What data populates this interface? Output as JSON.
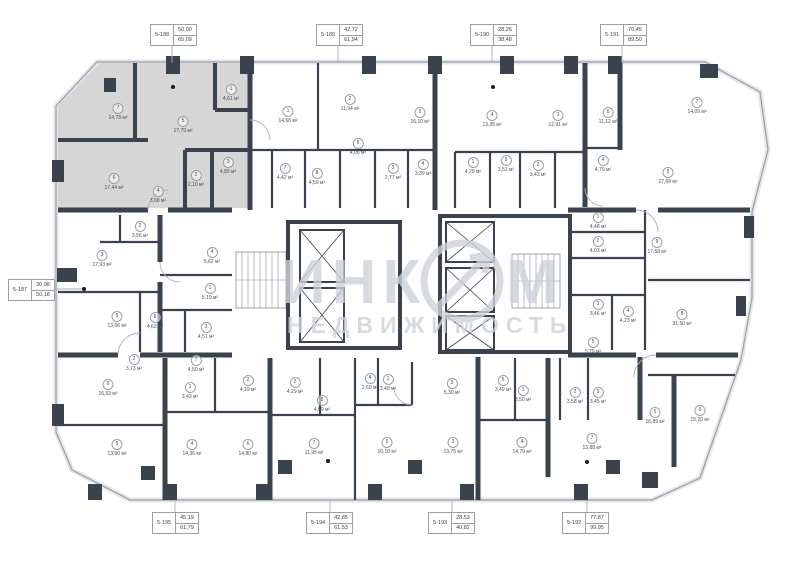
{
  "watermark": {
    "brand": "ИНКОМ",
    "brand_left": "ИНК",
    "brand_right": "М",
    "subtitle": "НЕДВИЖИМОСТЬ"
  },
  "units": [
    {
      "id": "5-188",
      "area1": "50,00",
      "area2": "65,09",
      "x": 150,
      "y": 24,
      "leader": [
        172,
        44,
        172,
        63
      ]
    },
    {
      "id": "5-189",
      "area1": "42,72",
      "area2": "61,94",
      "x": 316,
      "y": 24,
      "leader": [
        338,
        44,
        338,
        63
      ]
    },
    {
      "id": "5-190",
      "area1": "28,26",
      "area2": "38,48",
      "x": 470,
      "y": 24,
      "leader": [
        492,
        44,
        492,
        63
      ]
    },
    {
      "id": "5-191",
      "area1": "70,45",
      "area2": "89,50",
      "x": 600,
      "y": 24,
      "leader": [
        622,
        44,
        622,
        63
      ]
    },
    {
      "id": "5-187",
      "area1": "30,98",
      "area2": "50,18",
      "x": 8,
      "y": 279,
      "leader": [
        54,
        289,
        84,
        289
      ],
      "dot": [
        84,
        289
      ]
    },
    {
      "id": "5-195",
      "area1": "45,19",
      "area2": "61,79",
      "x": 152,
      "y": 512,
      "leader": [
        175,
        500,
        175,
        512
      ]
    },
    {
      "id": "5-194",
      "area1": "42,85",
      "area2": "61,53",
      "x": 306,
      "y": 512,
      "leader": [
        330,
        500,
        330,
        512
      ]
    },
    {
      "id": "5-193",
      "area1": "28,53",
      "area2": "40,82",
      "x": 428,
      "y": 512,
      "leader": [
        452,
        500,
        452,
        512
      ]
    },
    {
      "id": "5-192",
      "area1": "77,87",
      "area2": "99,95",
      "x": 562,
      "y": 512,
      "leader": [
        587,
        500,
        587,
        512
      ]
    }
  ],
  "rooms": [
    {
      "n": "7",
      "a": "14,78 м²",
      "x": 118,
      "y": 112
    },
    {
      "n": "5",
      "a": "17,79 м²",
      "x": 183,
      "y": 125
    },
    {
      "n": "1",
      "a": "4,61 м²",
      "x": 231,
      "y": 93
    },
    {
      "n": "3",
      "a": "4,89 м²",
      "x": 228,
      "y": 166
    },
    {
      "n": "2",
      "a": "2,10 м²",
      "x": 196,
      "y": 179
    },
    {
      "n": "6",
      "a": "17,44 м²",
      "x": 114,
      "y": 182
    },
    {
      "n": "4",
      "a": "3,68 м²",
      "x": 158,
      "y": 195
    },
    {
      "n": "1",
      "a": "14,68 м²",
      "x": 288,
      "y": 115
    },
    {
      "n": "2",
      "a": "11,94 м²",
      "x": 350,
      "y": 103
    },
    {
      "n": "6",
      "a": "4,06 м²",
      "x": 358,
      "y": 147
    },
    {
      "n": "7",
      "a": "4,42 м²",
      "x": 285,
      "y": 172
    },
    {
      "n": "8",
      "a": "4,59 м²",
      "x": 317,
      "y": 177
    },
    {
      "n": "3",
      "a": "2,77 м²",
      "x": 393,
      "y": 172
    },
    {
      "n": "5",
      "a": "16,10 м²",
      "x": 420,
      "y": 116
    },
    {
      "n": "4",
      "a": "3,39 м²",
      "x": 423,
      "y": 168
    },
    {
      "n": "4",
      "a": "13,35 м²",
      "x": 492,
      "y": 119
    },
    {
      "n": "3",
      "a": "12,91 м²",
      "x": 558,
      "y": 119
    },
    {
      "n": "6",
      "a": "11,12 м²",
      "x": 608,
      "y": 116
    },
    {
      "n": "1",
      "a": "4,29 м²",
      "x": 473,
      "y": 166
    },
    {
      "n": "5",
      "a": "3,51 м²",
      "x": 506,
      "y": 164
    },
    {
      "n": "2",
      "a": "3,43 м²",
      "x": 538,
      "y": 169
    },
    {
      "n": "4",
      "a": "4,79 м²",
      "x": 603,
      "y": 164
    },
    {
      "n": "7",
      "a": "14,09 м²",
      "x": 697,
      "y": 106
    },
    {
      "n": "5",
      "a": "27,68 м²",
      "x": 668,
      "y": 176
    },
    {
      "n": "1",
      "a": "4,48 м²",
      "x": 598,
      "y": 221
    },
    {
      "n": "2",
      "a": "4,03 м²",
      "x": 598,
      "y": 245
    },
    {
      "n": "3",
      "a": "3,46 м²",
      "x": 598,
      "y": 308
    },
    {
      "n": "4",
      "a": "4,23 м²",
      "x": 628,
      "y": 315
    },
    {
      "n": "9",
      "a": "17,58 м²",
      "x": 657,
      "y": 246
    },
    {
      "n": "8",
      "a": "31,50 м²",
      "x": 682,
      "y": 318
    },
    {
      "n": "3",
      "a": "17,93 м²",
      "x": 102,
      "y": 259
    },
    {
      "n": "2",
      "a": "3,56 м²",
      "x": 140,
      "y": 230
    },
    {
      "n": "4",
      "a": "5,62 м²",
      "x": 212,
      "y": 256
    },
    {
      "n": "1",
      "a": "5,19 м²",
      "x": 210,
      "y": 292
    },
    {
      "n": "5",
      "a": "13,06 м²",
      "x": 117,
      "y": 320
    },
    {
      "n": "6",
      "a": "4,63 м²",
      "x": 155,
      "y": 321
    },
    {
      "n": "3",
      "a": "4,51 м²",
      "x": 206,
      "y": 331
    },
    {
      "n": "2",
      "a": "3,73 м²",
      "x": 134,
      "y": 363
    },
    {
      "n": "7",
      "a": "4,50 м²",
      "x": 196,
      "y": 364
    },
    {
      "n": "6",
      "a": "16,93 м²",
      "x": 108,
      "y": 388
    },
    {
      "n": "1",
      "a": "3,43 м²",
      "x": 190,
      "y": 391
    },
    {
      "n": "2",
      "a": "4,19 м²",
      "x": 248,
      "y": 384
    },
    {
      "n": "5",
      "a": "13,90 м²",
      "x": 117,
      "y": 448
    },
    {
      "n": "4",
      "a": "14,36 м²",
      "x": 192,
      "y": 448
    },
    {
      "n": "6",
      "a": "14,80 м²",
      "x": 248,
      "y": 448
    },
    {
      "n": "2",
      "a": "4,29 м²",
      "x": 295,
      "y": 386
    },
    {
      "n": "8",
      "a": "4,09 м²",
      "x": 322,
      "y": 404
    },
    {
      "n": "7",
      "a": "11,95 м²",
      "x": 314,
      "y": 447
    },
    {
      "n": "4",
      "a": "2,69 м²",
      "x": 370,
      "y": 382
    },
    {
      "n": "1",
      "a": "3,49 м²",
      "x": 388,
      "y": 383
    },
    {
      "n": "3",
      "a": "5,30 м²",
      "x": 452,
      "y": 387
    },
    {
      "n": "5",
      "a": "16,10 м²",
      "x": 387,
      "y": 446
    },
    {
      "n": "3",
      "a": "13,75 м²",
      "x": 453,
      "y": 446
    },
    {
      "n": "5",
      "a": "5,79 м²",
      "x": 593,
      "y": 346
    },
    {
      "n": "5",
      "a": "3,49 м²",
      "x": 503,
      "y": 384
    },
    {
      "n": "1",
      "a": "3,50 м²",
      "x": 523,
      "y": 394
    },
    {
      "n": "2",
      "a": "3,58 м²",
      "x": 575,
      "y": 396
    },
    {
      "n": "9",
      "a": "3,45 м²",
      "x": 598,
      "y": 396
    },
    {
      "n": "4",
      "a": "14,79 м²",
      "x": 522,
      "y": 446
    },
    {
      "n": "7",
      "a": "13,88 м²",
      "x": 592,
      "y": 442
    },
    {
      "n": "5",
      "a": "16,89 м²",
      "x": 655,
      "y": 416
    },
    {
      "n": "6",
      "a": "15,20 м²",
      "x": 700,
      "y": 414
    }
  ]
}
